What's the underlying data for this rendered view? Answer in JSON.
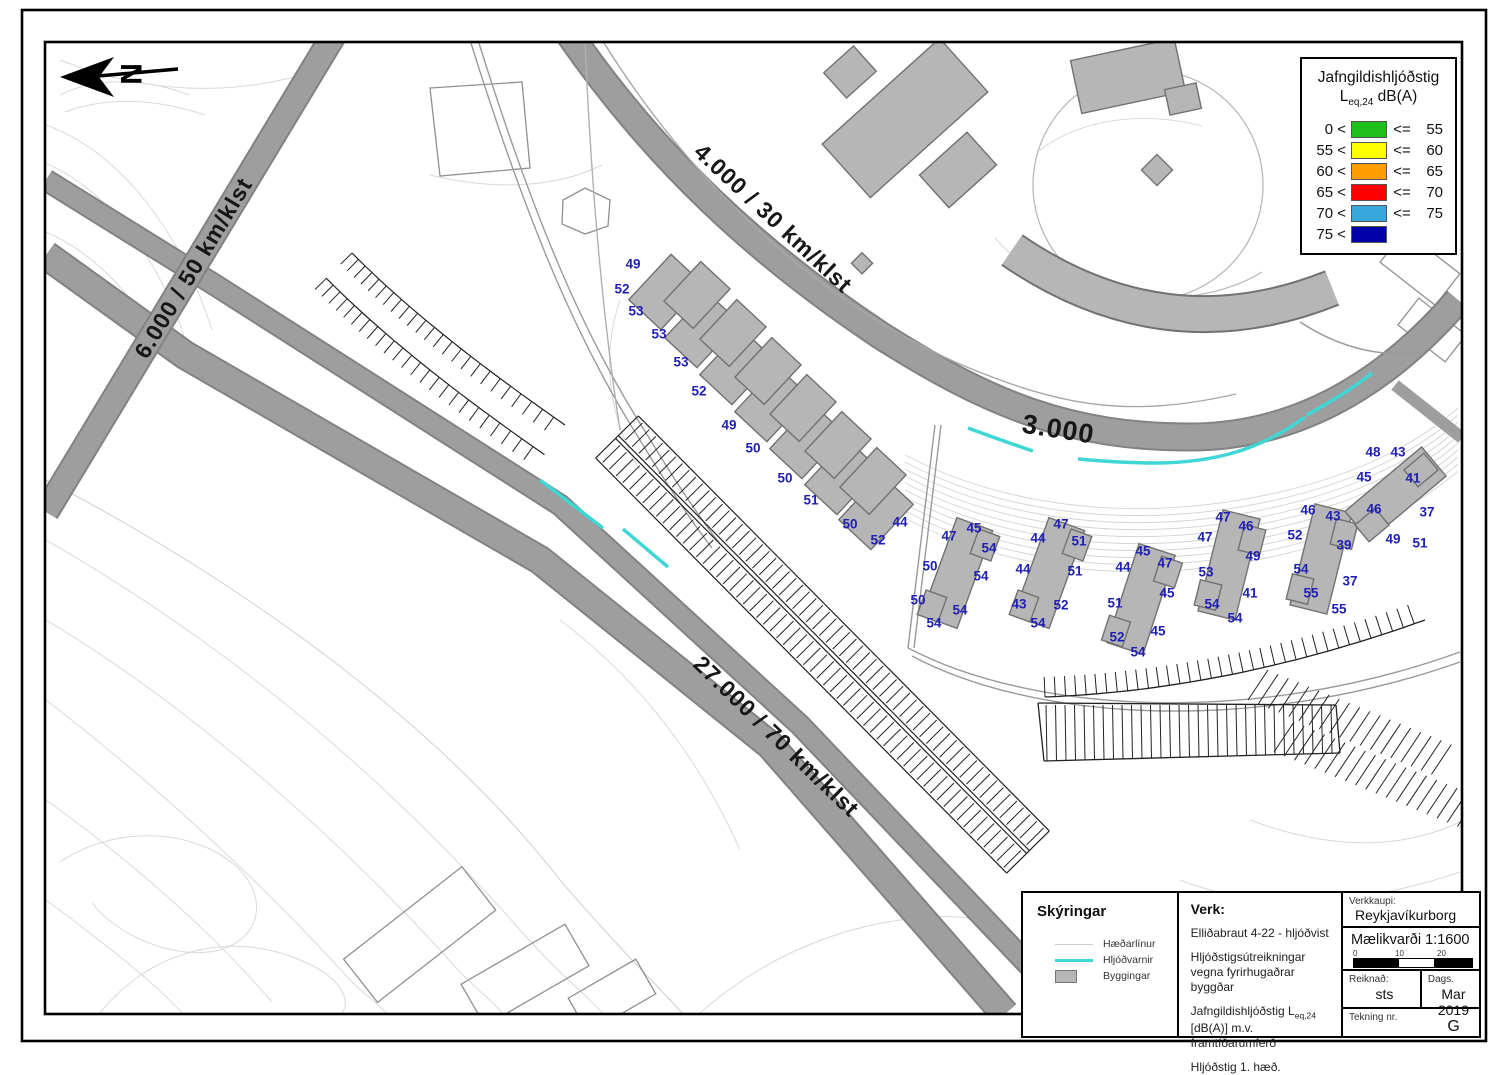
{
  "north": {
    "letter": "N"
  },
  "legend": {
    "title_line1": "Jafngildishljóðstig",
    "title_l": "L",
    "title_sub": "eq,24",
    "title_rest": " dB(A)",
    "rows": [
      {
        "left": "0 <",
        "color": "#1dbf1d",
        "op": "<=",
        "right": "55"
      },
      {
        "left": "55 <",
        "color": "#ffff00",
        "op": "<=",
        "right": "60"
      },
      {
        "left": "60 <",
        "color": "#ff9c00",
        "op": "<=",
        "right": "65"
      },
      {
        "left": "65 <",
        "color": "#ff0000",
        "op": "<=",
        "right": "70"
      },
      {
        "left": "70 <",
        "color": "#38a8dc",
        "op": "<=",
        "right": "75"
      },
      {
        "left": "75 <",
        "color": "#0000a8",
        "op": "",
        "right": ""
      }
    ]
  },
  "map": {
    "barrier_color": "#3fd6d6",
    "road_labels": [
      {
        "text": "6.000 / 50 km/klst",
        "x": 200,
        "y": 272,
        "rot": -59,
        "size": 23
      },
      {
        "text": "4.000 / 30 km/klst",
        "x": 768,
        "y": 224,
        "rot": 43,
        "size": 23
      },
      {
        "text": "3.000",
        "x": 1057,
        "y": 438,
        "rot": 9,
        "size": 27
      },
      {
        "text": "27.000 / 70 km/klst",
        "x": 771,
        "y": 742,
        "rot": 44,
        "size": 23
      }
    ],
    "noise_values": [
      {
        "v": 49,
        "x": 633,
        "y": 264
      },
      {
        "v": 52,
        "x": 622,
        "y": 289
      },
      {
        "v": 53,
        "x": 636,
        "y": 311
      },
      {
        "v": 53,
        "x": 659,
        "y": 334
      },
      {
        "v": 53,
        "x": 681,
        "y": 362
      },
      {
        "v": 52,
        "x": 699,
        "y": 391
      },
      {
        "v": 49,
        "x": 729,
        "y": 425
      },
      {
        "v": 50,
        "x": 753,
        "y": 448
      },
      {
        "v": 50,
        "x": 785,
        "y": 478
      },
      {
        "v": 51,
        "x": 811,
        "y": 500
      },
      {
        "v": 50,
        "x": 850,
        "y": 524
      },
      {
        "v": 52,
        "x": 878,
        "y": 540
      },
      {
        "v": 44,
        "x": 900,
        "y": 522
      },
      {
        "v": 47,
        "x": 949,
        "y": 536
      },
      {
        "v": 45,
        "x": 974,
        "y": 528
      },
      {
        "v": 54,
        "x": 989,
        "y": 548
      },
      {
        "v": 50,
        "x": 930,
        "y": 566
      },
      {
        "v": 54,
        "x": 981,
        "y": 576
      },
      {
        "v": 50,
        "x": 918,
        "y": 600
      },
      {
        "v": 54,
        "x": 960,
        "y": 610
      },
      {
        "v": 54,
        "x": 934,
        "y": 623
      },
      {
        "v": 44,
        "x": 1038,
        "y": 538
      },
      {
        "v": 47,
        "x": 1061,
        "y": 524
      },
      {
        "v": 51,
        "x": 1079,
        "y": 541
      },
      {
        "v": 44,
        "x": 1023,
        "y": 569
      },
      {
        "v": 51,
        "x": 1075,
        "y": 571
      },
      {
        "v": 43,
        "x": 1019,
        "y": 604
      },
      {
        "v": 52,
        "x": 1061,
        "y": 605
      },
      {
        "v": 54,
        "x": 1038,
        "y": 623
      },
      {
        "v": 45,
        "x": 1143,
        "y": 551
      },
      {
        "v": 44,
        "x": 1123,
        "y": 567
      },
      {
        "v": 47,
        "x": 1165,
        "y": 563
      },
      {
        "v": 51,
        "x": 1115,
        "y": 603
      },
      {
        "v": 45,
        "x": 1167,
        "y": 593
      },
      {
        "v": 52,
        "x": 1117,
        "y": 637
      },
      {
        "v": 45,
        "x": 1158,
        "y": 631
      },
      {
        "v": 54,
        "x": 1138,
        "y": 652
      },
      {
        "v": 47,
        "x": 1223,
        "y": 517
      },
      {
        "v": 46,
        "x": 1246,
        "y": 526
      },
      {
        "v": 47,
        "x": 1205,
        "y": 537
      },
      {
        "v": 49,
        "x": 1253,
        "y": 556
      },
      {
        "v": 53,
        "x": 1206,
        "y": 572
      },
      {
        "v": 41,
        "x": 1250,
        "y": 593
      },
      {
        "v": 54,
        "x": 1212,
        "y": 604
      },
      {
        "v": 54,
        "x": 1235,
        "y": 618
      },
      {
        "v": 46,
        "x": 1308,
        "y": 510
      },
      {
        "v": 43,
        "x": 1333,
        "y": 516
      },
      {
        "v": 52,
        "x": 1295,
        "y": 535
      },
      {
        "v": 39,
        "x": 1344,
        "y": 545
      },
      {
        "v": 54,
        "x": 1301,
        "y": 569
      },
      {
        "v": 37,
        "x": 1350,
        "y": 581
      },
      {
        "v": 55,
        "x": 1311,
        "y": 593
      },
      {
        "v": 55,
        "x": 1339,
        "y": 609
      },
      {
        "v": 48,
        "x": 1373,
        "y": 452
      },
      {
        "v": 43,
        "x": 1398,
        "y": 452
      },
      {
        "v": 45,
        "x": 1364,
        "y": 477
      },
      {
        "v": 41,
        "x": 1413,
        "y": 478
      },
      {
        "v": 46,
        "x": 1374,
        "y": 509
      },
      {
        "v": 37,
        "x": 1427,
        "y": 512
      },
      {
        "v": 49,
        "x": 1393,
        "y": 539
      },
      {
        "v": 51,
        "x": 1420,
        "y": 543
      }
    ]
  },
  "titleblock": {
    "skyringar": {
      "title": "Skýringar",
      "items": [
        {
          "kind": "contour",
          "label": "Hæðarlínur"
        },
        {
          "kind": "barrier",
          "label": "Hljóðvarnir"
        },
        {
          "kind": "building",
          "label": "Byggingar"
        }
      ]
    },
    "verk": {
      "label": "Verk:",
      "p1": "Elliðabraut 4-22 - hljóðvist",
      "p2": "Hljóðstigsútreikningar vegna fyrirhugaðrar byggðar",
      "p3_pre": "Jafngildishljóðstig L",
      "p3_sub": "eq,24",
      "p3_post": " [dB(A)] m.v. framtíðarumferð",
      "p4": "Hljóðstig 1. hæð."
    },
    "verkkaupi": {
      "label": "Verkkaupi:",
      "value": "Reykjavíkurborg"
    },
    "scale": {
      "label": "Mælikvarði 1:1600",
      "ticks": [
        "0",
        "10",
        "20"
      ]
    },
    "reiknad": {
      "label": "Reiknað:",
      "value": "sts"
    },
    "dags": {
      "label": "Dags.",
      "value": "Mar 2019"
    },
    "teikning": {
      "label": "Tekning nr.",
      "value": "G"
    }
  }
}
